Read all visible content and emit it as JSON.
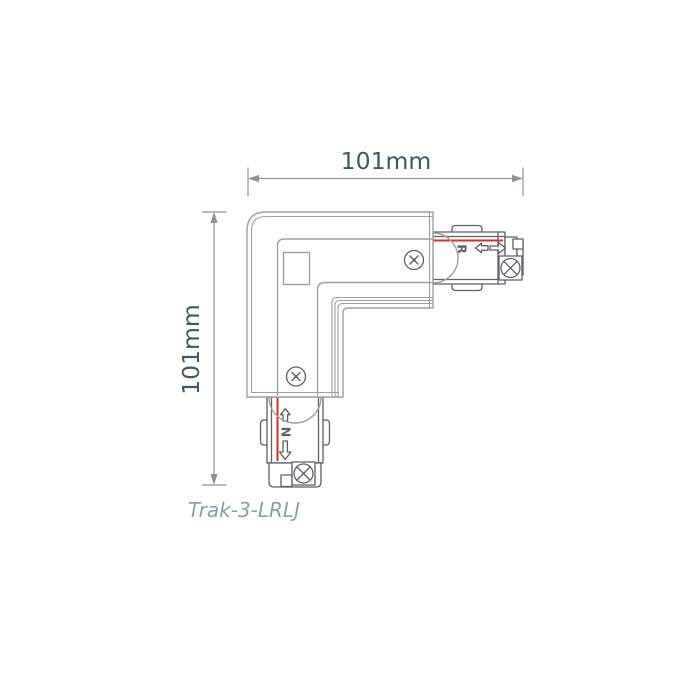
{
  "diagram": {
    "title_hidden": "",
    "width_dimension": "101mm",
    "height_dimension": "101mm",
    "product_code": "Trak-3-LRLJ",
    "markings": {
      "right_connector": "R",
      "bottom_connector": "N"
    }
  },
  "colors": {
    "body_line": "#9aa1a7",
    "detail_line": "#5c6165",
    "dimension_line": "#8d9298",
    "dimension_text": "#44546a",
    "product_code_text": "#8c9cb1",
    "conductor_red": "#e02b20",
    "background": "#ffffff"
  }
}
